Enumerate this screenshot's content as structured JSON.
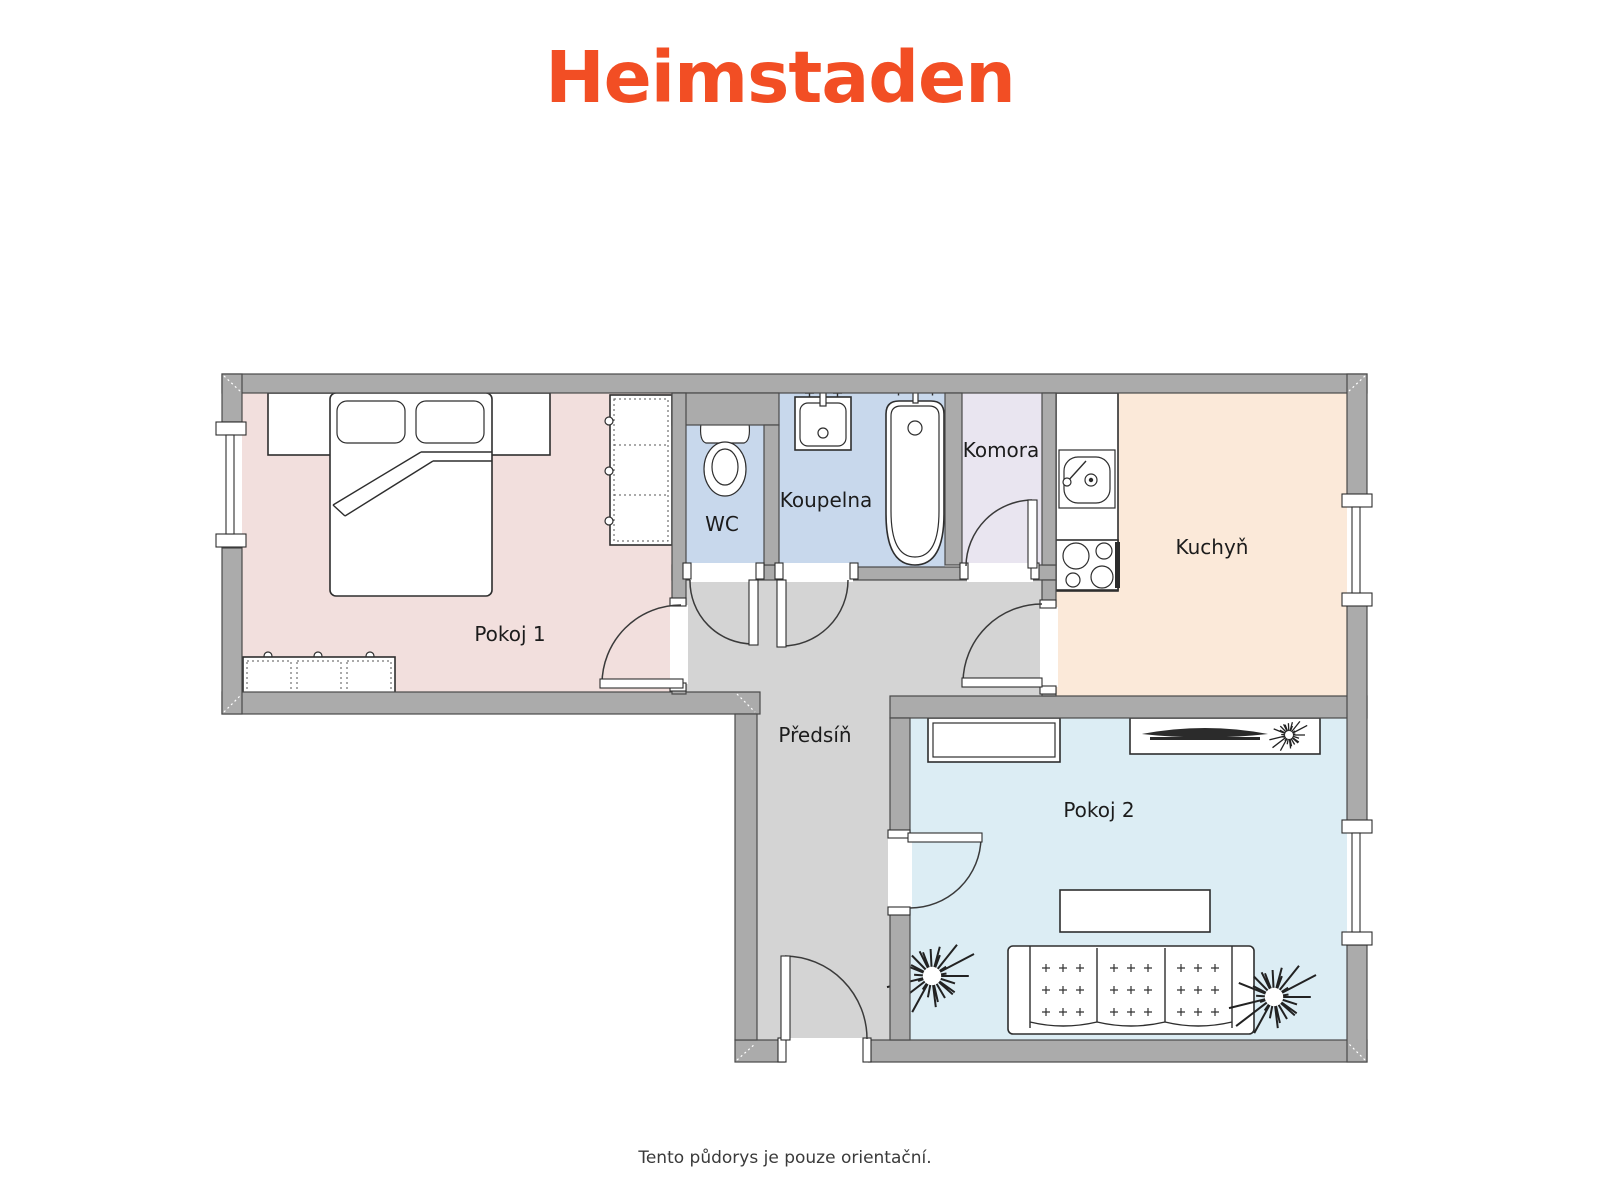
{
  "logo": {
    "text": "Heimstaden",
    "color": "#f24e24"
  },
  "footer": {
    "note": "Tento půdorys je pouze orientační."
  },
  "floorplan": {
    "rooms": [
      {
        "id": "pokoj-1",
        "label": "Pokoj 1",
        "color": "#f2dfdd"
      },
      {
        "id": "wc",
        "label": "WC",
        "color": "#c8d8ec"
      },
      {
        "id": "koupelna",
        "label": "Koupelna",
        "color": "#c8d8ec"
      },
      {
        "id": "komora",
        "label": "Komora",
        "color": "#e9e5f0"
      },
      {
        "id": "kuchyn",
        "label": "Kuchyň",
        "color": "#fbe9d9"
      },
      {
        "id": "predsin",
        "label": "Předsíň",
        "color": "#d4d4d4"
      },
      {
        "id": "pokoj-2",
        "label": "Pokoj 2",
        "color": "#dcedf4"
      }
    ],
    "theme": {
      "wall": "#ababab",
      "outline": "#4a4a4a",
      "label": "#1c1c1c"
    }
  }
}
